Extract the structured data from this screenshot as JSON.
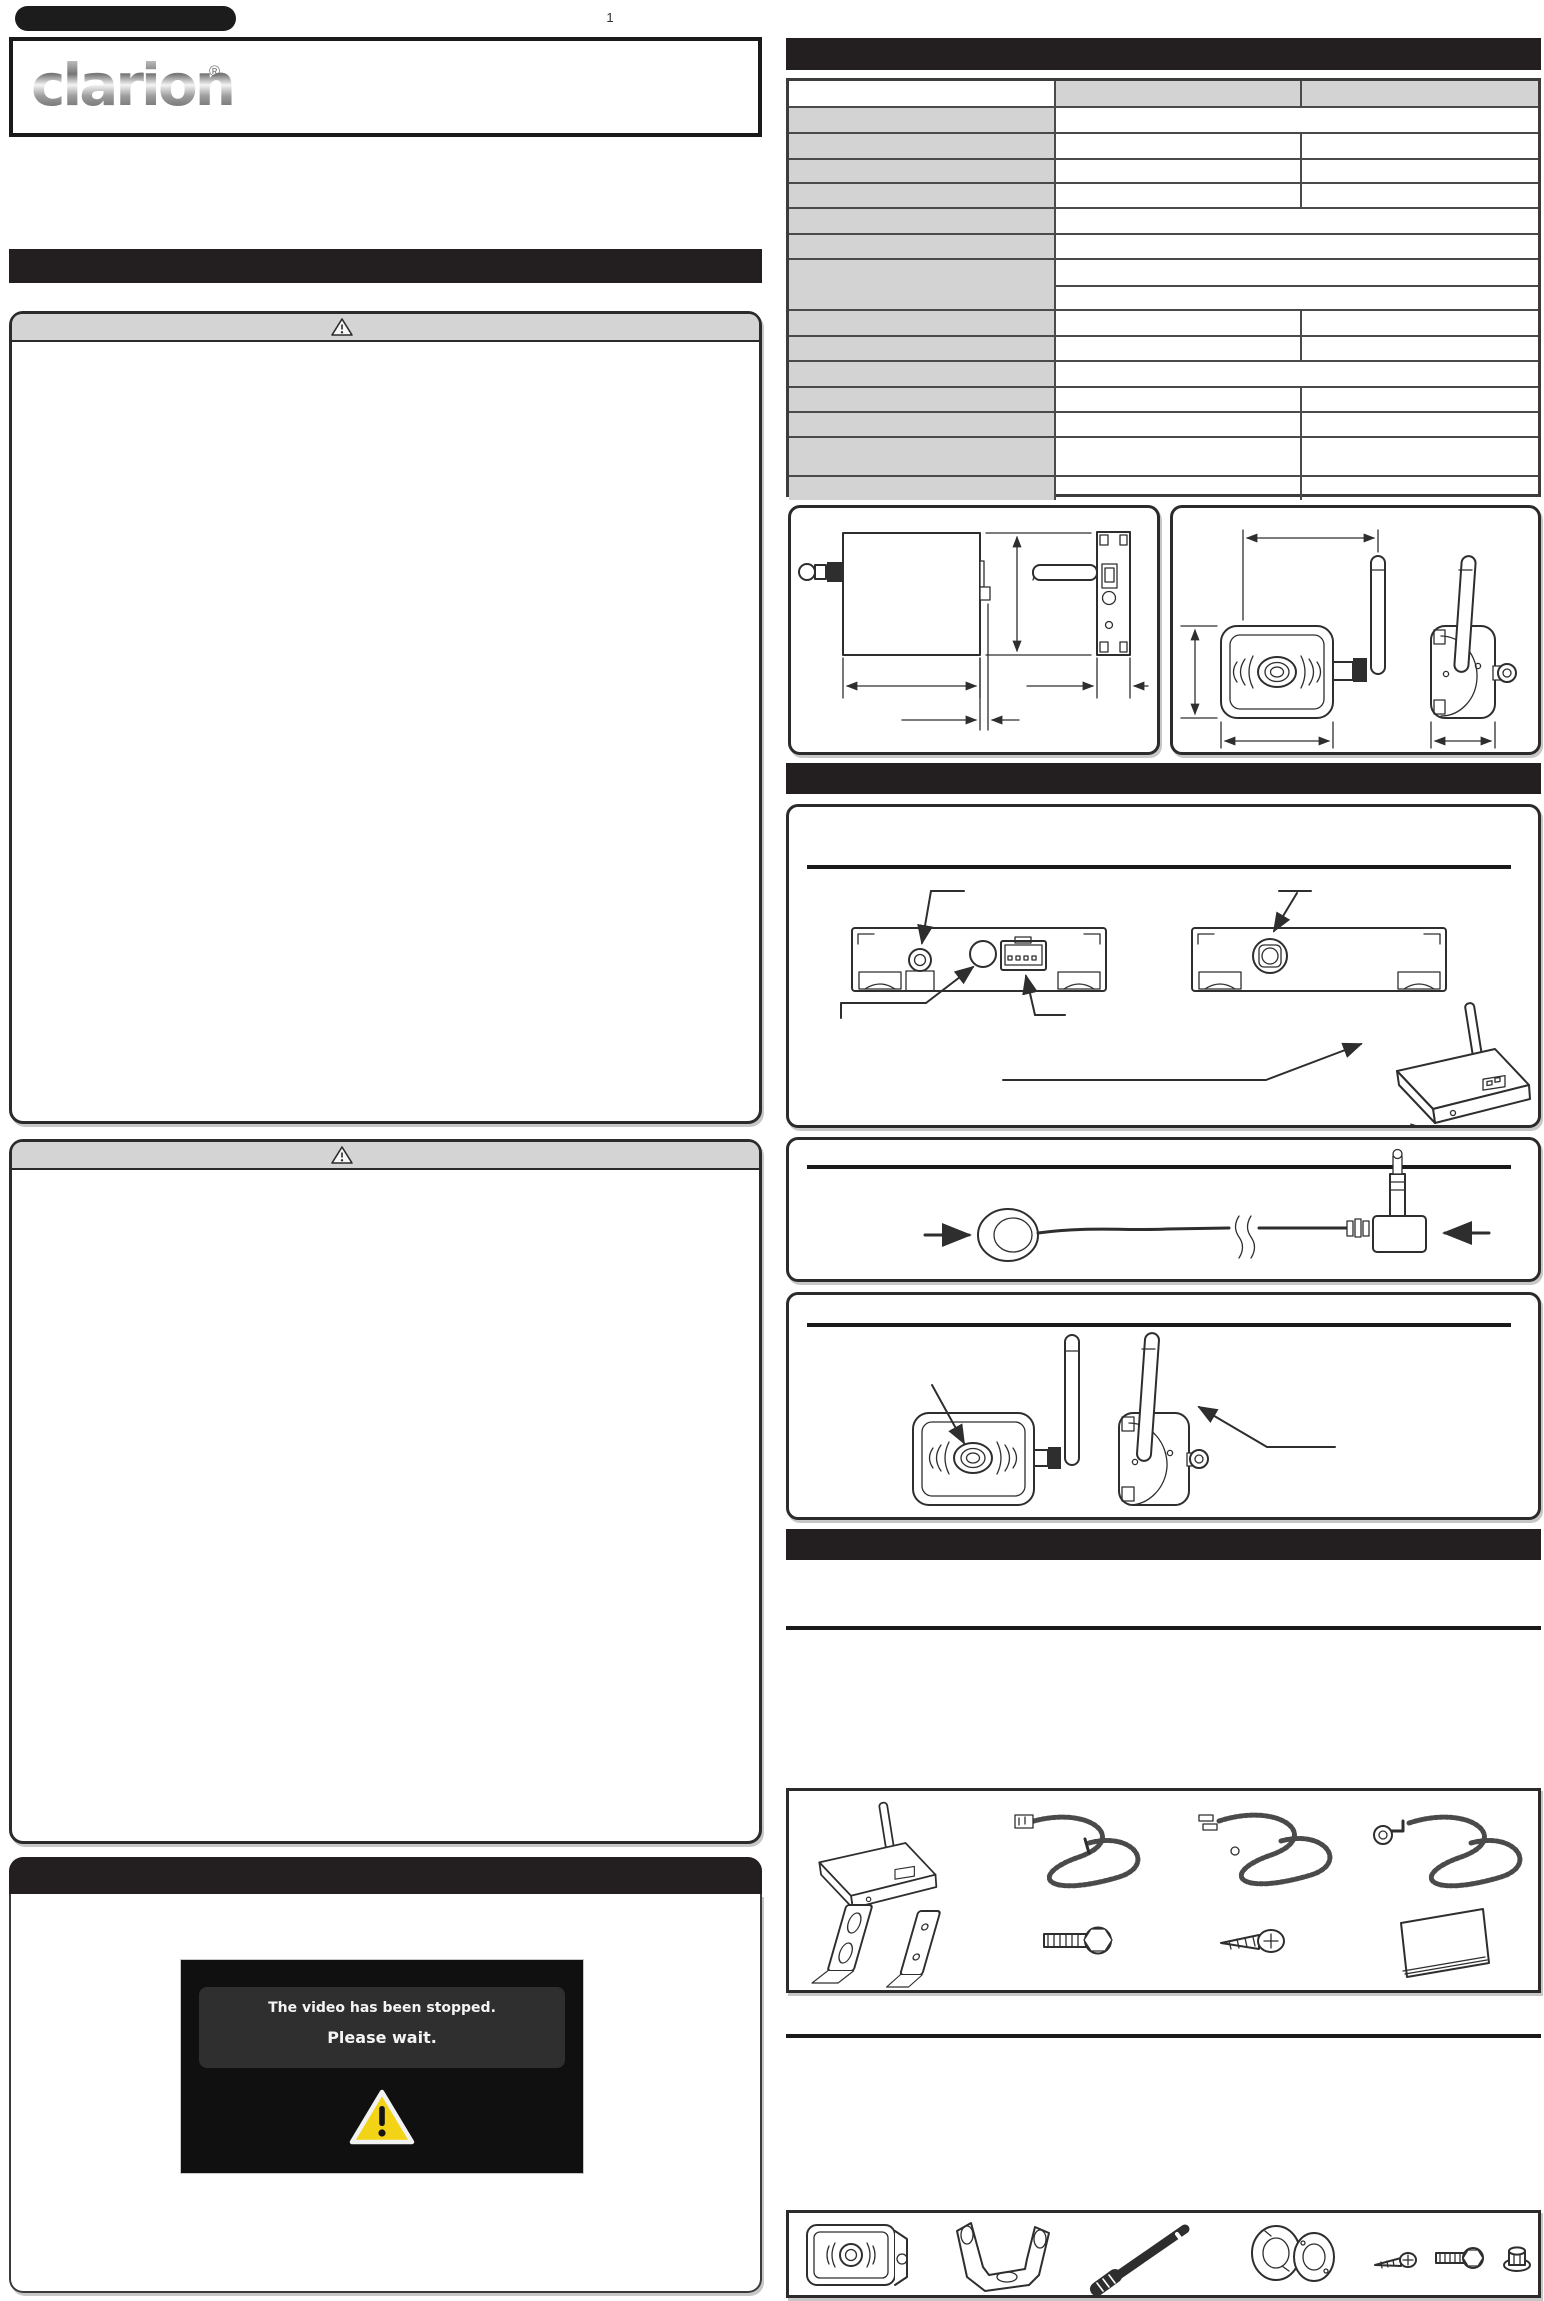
{
  "document": {
    "page_number": "1",
    "kind": "instruction-sheet",
    "note_visible_text_only": "All body copy on the scanned sheet is blank; only structure, drawings and the items below are visible."
  },
  "brand": {
    "logo_text": "clarion",
    "registered_mark": "®"
  },
  "screen_mockup": {
    "line1": "The video has been stopped.",
    "line2": "Please wait.",
    "icon": "yellow-warning-triangle"
  },
  "spec_table": {
    "columns": {
      "label_width": 265,
      "value_widths": [
        244,
        244
      ]
    },
    "rows": [
      {
        "h": 25,
        "type": "header"
      },
      {
        "h": 26,
        "type": "merged"
      },
      {
        "h": 26,
        "type": "split"
      },
      {
        "h": 24,
        "type": "split"
      },
      {
        "h": 25,
        "type": "split"
      },
      {
        "h": 26,
        "type": "merged"
      },
      {
        "h": 25,
        "type": "merged"
      },
      {
        "h": 51,
        "type": "double"
      },
      {
        "h": 26,
        "type": "split"
      },
      {
        "h": 25,
        "type": "split"
      },
      {
        "h": 26,
        "type": "merged"
      },
      {
        "h": 25,
        "type": "split"
      },
      {
        "h": 25,
        "type": "split"
      },
      {
        "h": 39,
        "type": "split"
      },
      {
        "h": 25,
        "type": "split"
      }
    ]
  },
  "colors": {
    "section_bar": "#231f20",
    "table_label_bg": "#d3d3d3",
    "table_border": "#4a4a4a",
    "warning_header_bg": "#d4d4d4",
    "screen_bg": "#101010",
    "screen_msgbox_bg": "#2f2f2f",
    "warning_yellow": "#f3d316",
    "line_art": "#2e2e2e"
  },
  "icons": {
    "header": [
      "model-badge",
      "clarion-logo"
    ],
    "warning": [
      "warning-triangle-icon",
      "yellow-warning-triangle-icon"
    ],
    "figures": [
      "transmitter-dimension-drawing",
      "camera-dimension-drawing",
      "head-unit-rear-diagram",
      "wireless-transmitter-icon",
      "extension-cable-drawing",
      "camera-front-drawing",
      "camera-side-drawing",
      "mounting-bracket-icon",
      "hex-bolt-icon",
      "tapping-screw-icon",
      "manual-booklet-icon",
      "u-bracket-icon",
      "antenna-icon",
      "washer-icon",
      "nut-icon"
    ]
  }
}
